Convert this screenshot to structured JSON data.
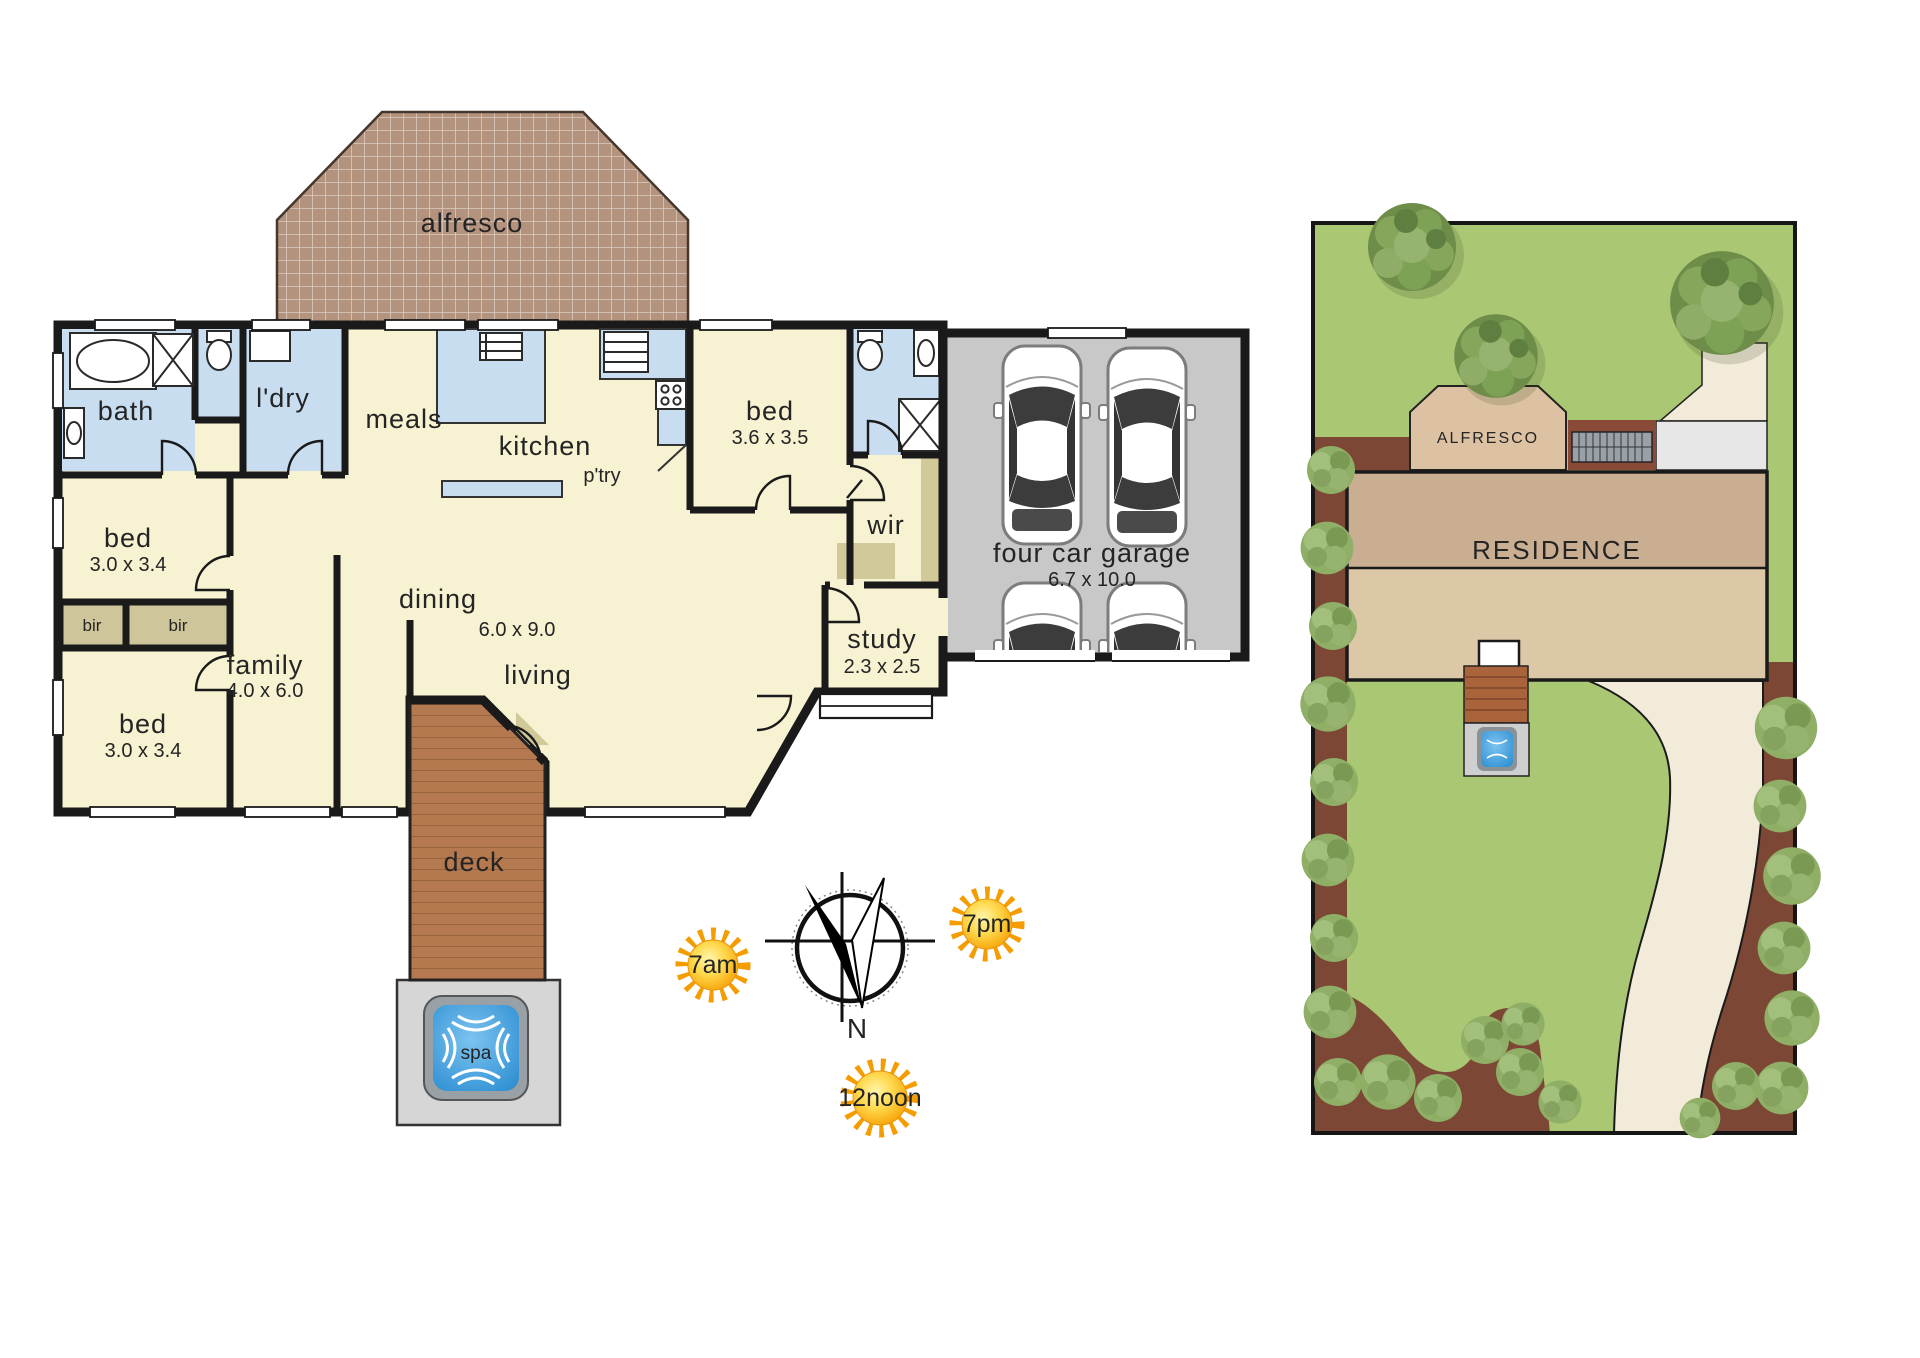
{
  "floor_plan": {
    "alfresco": {
      "label": "alfresco"
    },
    "bath": {
      "label": "bath"
    },
    "laundry": {
      "label": "l'dry"
    },
    "meals": {
      "label": "meals"
    },
    "kitchen": {
      "label": "kitchen"
    },
    "pantry": {
      "label": "p'try"
    },
    "bed_rear": {
      "label": "bed",
      "dims": "3.6 x 3.5"
    },
    "bed_mid": {
      "label": "bed",
      "dims": "3.0 x 3.4"
    },
    "bed_front": {
      "label": "bed",
      "dims": "3.0 x 3.4"
    },
    "bir_left": {
      "label": "bir"
    },
    "bir_right": {
      "label": "bir"
    },
    "family": {
      "label": "family",
      "dims": "4.0 x 6.0"
    },
    "dining": {
      "label": "dining",
      "dims": "6.0 x 9.0"
    },
    "living": {
      "label": "living"
    },
    "wir": {
      "label": "wir"
    },
    "study": {
      "label": "study",
      "dims": "2.3 x 2.5"
    },
    "garage": {
      "label": "four car garage",
      "dims": "6.7 x 10.0"
    },
    "deck": {
      "label": "deck"
    },
    "spa": {
      "label": "spa"
    }
  },
  "orientation": {
    "north": "N",
    "sun_morning": "7am",
    "sun_evening": "7pm",
    "sun_noon": "12noon"
  },
  "site_plan": {
    "alfresco": "ALFRESCO",
    "residence": "RESIDENCE"
  },
  "colors": {
    "room_fill": "#f6f2d2",
    "wet_area_fill": "#c9ddf1",
    "robe_fill": "#d2c99b",
    "wall": "#1a1a1a",
    "garage_fill": "#c8c8c8",
    "deck_fill": "#b5794f",
    "alfresco_brick": "#b3927e",
    "spa_water": "#45a1e0",
    "lawn": "#aac873",
    "garden_bed": "#7c4734",
    "driveway": "#f2ebda",
    "residence_roof_dark": "#c9ae92",
    "residence_roof_light": "#dcc7a6",
    "sun": "#f59d00"
  }
}
